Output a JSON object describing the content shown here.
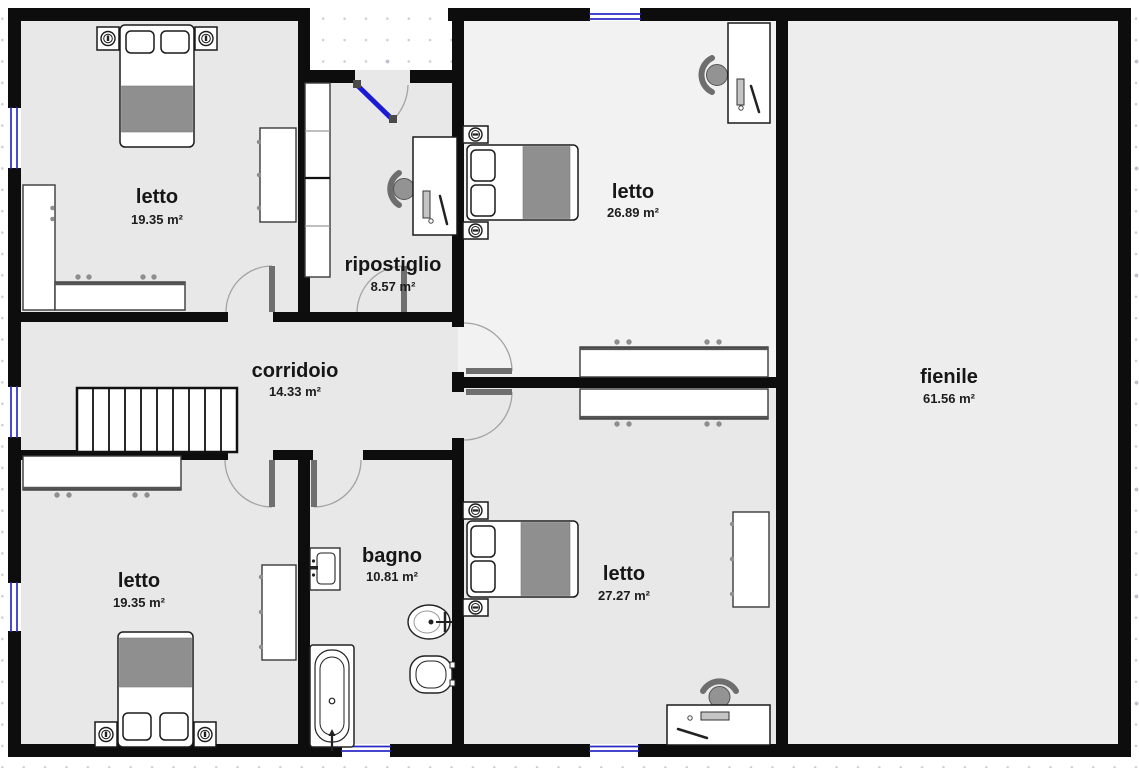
{
  "plan": {
    "title": "floor-plan",
    "rooms": [
      {
        "id": "letto-top-left",
        "name": "letto",
        "area": "19.35 m²"
      },
      {
        "id": "ripostiglio",
        "name": "ripostiglio",
        "area": "8.57 m²"
      },
      {
        "id": "letto-top-middle",
        "name": "letto",
        "area": "26.89 m²"
      },
      {
        "id": "corridoio",
        "name": "corridoio",
        "area": "14.33 m²"
      },
      {
        "id": "letto-bottom-left",
        "name": "letto",
        "area": "19.35 m²"
      },
      {
        "id": "bagno",
        "name": "bagno",
        "area": "10.81 m²"
      },
      {
        "id": "letto-bottom-middle",
        "name": "letto",
        "area": "27.27 m²"
      },
      {
        "id": "fienile",
        "name": "fienile",
        "area": "61.56 m²"
      }
    ],
    "colors": {
      "wall": "#0d0d0d",
      "floor": "#e8e8e8",
      "floor_light": "#f2f2f2",
      "floor_fienile": "#ededed",
      "window_blue": "#2b2bc4",
      "door_leaf_blue": "#1b1bd6",
      "furniture_gray": "#8f8f8f"
    },
    "furniture_icons": [
      "double-bed",
      "nightstand-with-lamp",
      "wardrobe",
      "dresser",
      "bookshelf",
      "desk-with-chair",
      "staircase",
      "bathtub",
      "sink",
      "toilet",
      "bidet",
      "entry-door"
    ],
    "counts": {
      "windows": 6,
      "doors": 7,
      "stair_treads": 10
    }
  }
}
